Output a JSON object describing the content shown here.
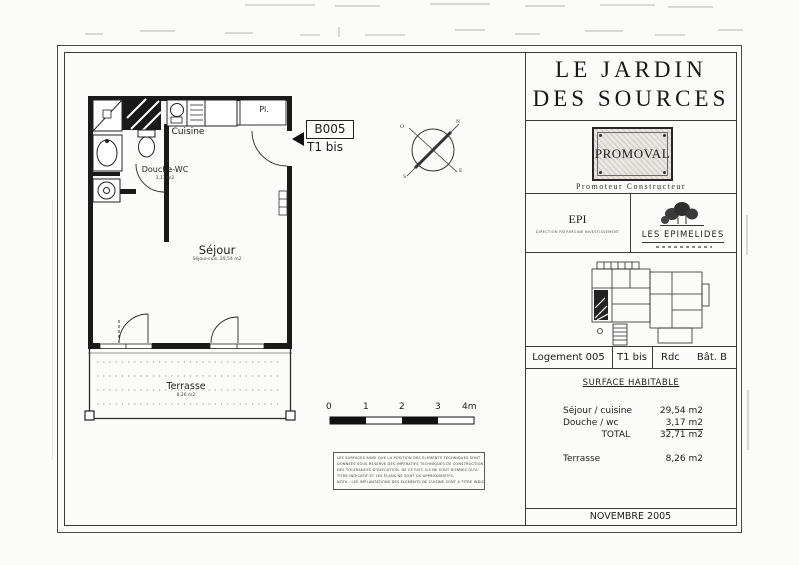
{
  "plan": {
    "unit_code": "B005",
    "unit_type": "T1 bis",
    "labels": {
      "cuisine": "Cuisine",
      "closet": "Pl.",
      "shower_wc": "Douche-WC",
      "shower_wc_area": "3,17 m2",
      "living": "Séjour",
      "living_sub": "Séjour-cuis. 29,54 m2",
      "terrace": "Terrasse",
      "terrace_area": "8,26 m2"
    },
    "compass": {
      "n": "N",
      "s": "S",
      "e": "E",
      "o": "O"
    },
    "scale_ticks": [
      "0",
      "1",
      "2",
      "3",
      "4m"
    ],
    "notes": [
      "LES SURFACES AINSI QUE LA POSITION DES ELEMENTS TECHNIQUES SONT",
      "DONNEES SOUS RESERVE DES IMPERATIFS TECHNIQUES DE CONSTRUCTION ET",
      "DES TOLERANCES D'EXECUTION. DE CE FAIT, ILS NE SONT DONNES QU'A",
      "TITRE INDICATIF ET LES PLANS NE SONT QU'APPROXIMATIFS.",
      "NOTA : LES IMPLANTATIONS DES ELEMENTS DE CUISINE SONT A TITRE INDICATIF."
    ]
  },
  "titleblock": {
    "project_name_line1": "LE JARDIN",
    "project_name_line2": "DES SOURCES",
    "developer_name": "PROMOVAL",
    "developer_role": "Promoteur Constructeur",
    "partner_epi": "EPI",
    "partner_epi_sub": "DIRECTION PATRIMOINE INVESTISSEMENT",
    "partner_epimelides": "LES EPIMELIDES",
    "unit_row": {
      "logement": "Logement 005",
      "type": "T1 bis",
      "level": "Rdc",
      "building": "Bât. B"
    },
    "surface_title": "SURFACE HABITABLE",
    "surfaces": [
      {
        "label": "Séjour / cuisine",
        "value": "29,54 m2"
      },
      {
        "label": "Douche / wc",
        "value": "3,17 m2"
      },
      {
        "label": "TOTAL",
        "value": "32,71 m2"
      },
      {
        "label": "Terrasse",
        "value": "8,26 m2"
      }
    ],
    "date": "NOVEMBRE 2005"
  }
}
